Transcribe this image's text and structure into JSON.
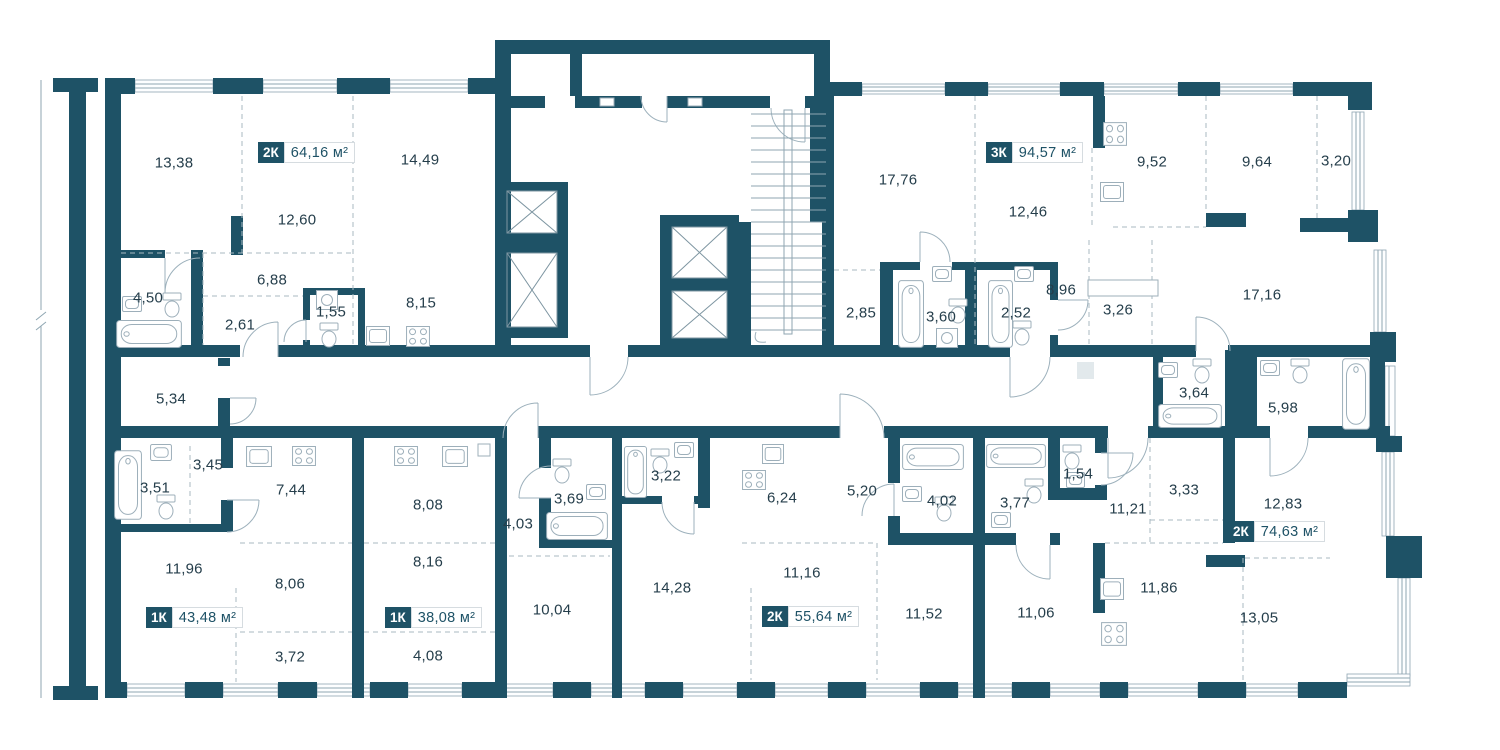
{
  "plan_type": "residential-floor-plan",
  "colors": {
    "wall": "#1E5266",
    "fixture_line": "#9DAFBA",
    "dashed_line": "#A8B9C2",
    "label_text": "#253E4B",
    "badge_text": "#1E5266",
    "badge_chip_bg": "#1E5266",
    "badge_chip_text": "#FFFFFF",
    "background": "#FFFFFF"
  },
  "apartments": [
    {
      "id": "apt-2k-6416",
      "type": "2К",
      "area": "64,16 м²",
      "badge": {
        "x": 258,
        "y": 142
      },
      "rooms": [
        {
          "v": "13,38",
          "x": 174,
          "y": 163
        },
        {
          "v": "14,49",
          "x": 420,
          "y": 160
        },
        {
          "v": "12,60",
          "x": 297,
          "y": 220
        },
        {
          "v": "6,88",
          "x": 272,
          "y": 280
        },
        {
          "v": "4,50",
          "x": 148,
          "y": 298
        },
        {
          "v": "2,61",
          "x": 240,
          "y": 325
        },
        {
          "v": "1,55",
          "x": 331,
          "y": 312
        },
        {
          "v": "8,15",
          "x": 421,
          "y": 303
        }
      ]
    },
    {
      "id": "apt-3k-9457",
      "type": "3К",
      "area": "94,57 м²",
      "badge": {
        "x": 986,
        "y": 142
      },
      "rooms": [
        {
          "v": "17,76",
          "x": 898,
          "y": 180
        },
        {
          "v": "12,46",
          "x": 1028,
          "y": 212
        },
        {
          "v": "9,52",
          "x": 1152,
          "y": 162
        },
        {
          "v": "9,64",
          "x": 1257,
          "y": 162
        },
        {
          "v": "3,20",
          "x": 1336,
          "y": 161
        },
        {
          "v": "2,85",
          "x": 861,
          "y": 313
        },
        {
          "v": "3,60",
          "x": 941,
          "y": 317
        },
        {
          "v": "2,52",
          "x": 1016,
          "y": 313
        },
        {
          "v": "8,96",
          "x": 1061,
          "y": 290
        },
        {
          "v": "3,26",
          "x": 1118,
          "y": 310
        },
        {
          "v": "17,16",
          "x": 1262,
          "y": 295
        },
        {
          "v": "3,64",
          "x": 1194,
          "y": 393
        }
      ]
    },
    {
      "id": "apt-1k-4348",
      "type": "1К",
      "area": "43,48 м²",
      "badge": {
        "x": 146,
        "y": 607
      },
      "rooms": [
        {
          "v": "5,34",
          "x": 171,
          "y": 399
        },
        {
          "v": "3,45",
          "x": 208,
          "y": 465
        },
        {
          "v": "3,51",
          "x": 155,
          "y": 488
        },
        {
          "v": "7,44",
          "x": 291,
          "y": 490
        },
        {
          "v": "11,96",
          "x": 184,
          "y": 569
        },
        {
          "v": "8,06",
          "x": 290,
          "y": 584
        },
        {
          "v": "3,72",
          "x": 290,
          "y": 657
        }
      ]
    },
    {
      "id": "apt-1k-3808",
      "type": "1К",
      "area": "38,08 м²",
      "badge": {
        "x": 385,
        "y": 607
      },
      "rooms": [
        {
          "v": "8,08",
          "x": 428,
          "y": 505
        },
        {
          "v": "8,16",
          "x": 428,
          "y": 562
        },
        {
          "v": "4,08",
          "x": 428,
          "y": 656
        },
        {
          "v": "4,03",
          "x": 518,
          "y": 524
        },
        {
          "v": "3,69",
          "x": 569,
          "y": 499
        },
        {
          "v": "10,04",
          "x": 552,
          "y": 610
        }
      ]
    },
    {
      "id": "apt-2k-5564",
      "type": "2К",
      "area": "55,64 м²",
      "badge": {
        "x": 762,
        "y": 606
      },
      "rooms": [
        {
          "v": "3,22",
          "x": 666,
          "y": 476
        },
        {
          "v": "6,24",
          "x": 782,
          "y": 498
        },
        {
          "v": "5,20",
          "x": 862,
          "y": 491
        },
        {
          "v": "4,02",
          "x": 942,
          "y": 501
        },
        {
          "v": "14,28",
          "x": 672,
          "y": 588
        },
        {
          "v": "11,16",
          "x": 802,
          "y": 573
        },
        {
          "v": "11,52",
          "x": 924,
          "y": 614
        }
      ]
    },
    {
      "id": "apt-2k-7463",
      "type": "2К",
      "area": "74,63 м²",
      "badge": {
        "x": 1228,
        "y": 521
      },
      "rooms": [
        {
          "v": "3,77",
          "x": 1015,
          "y": 503
        },
        {
          "v": "1,54",
          "x": 1078,
          "y": 474
        },
        {
          "v": "11,21",
          "x": 1128,
          "y": 509
        },
        {
          "v": "3,33",
          "x": 1184,
          "y": 490
        },
        {
          "v": "5,98",
          "x": 1283,
          "y": 408
        },
        {
          "v": "12,83",
          "x": 1283,
          "y": 504
        },
        {
          "v": "11,06",
          "x": 1036,
          "y": 613
        },
        {
          "v": "11,86",
          "x": 1159,
          "y": 588
        },
        {
          "v": "13,05",
          "x": 1259,
          "y": 618
        }
      ]
    }
  ]
}
